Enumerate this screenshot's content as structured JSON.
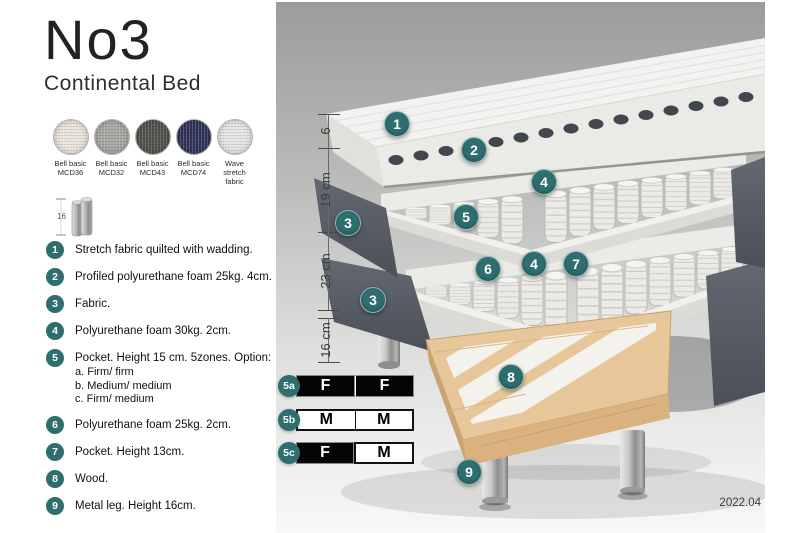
{
  "colors": {
    "accent": "#2e6e6e",
    "navy_swatch": "#32355a",
    "panel_top_gray": "#9c9c9c"
  },
  "header": {
    "title": "No3",
    "subtitle": "Continental Bed"
  },
  "swatches": [
    {
      "line1": "Bell basic",
      "line2": "MCD36",
      "color": "#e9e5db"
    },
    {
      "line1": "Bell basic",
      "line2": "MCD32",
      "color": "#a8a6a2"
    },
    {
      "line1": "Bell basic",
      "line2": "MCD43",
      "color": "#53514d"
    },
    {
      "line1": "Bell basic",
      "line2": "MCD74",
      "color": "#32355a"
    },
    {
      "line1": "Wave",
      "line2": "stretch fabric",
      "color": "#e3e5e7"
    }
  ],
  "leg_icon": {
    "label": "16"
  },
  "legend": [
    {
      "num": "1",
      "text": "Stretch fabric quilted with wadding."
    },
    {
      "num": "2",
      "text": "Profiled polyurethane foam 25kg. 4cm."
    },
    {
      "num": "3",
      "text": "Fabric."
    },
    {
      "num": "4",
      "text": "Polyurethane foam 30kg. 2cm."
    },
    {
      "num": "5",
      "text": "Pocket. Height 15 cm. 5zones. Option:",
      "options": [
        "a. Firm/ firm",
        "b. Medium/ medium",
        "c. Firm/ medium"
      ]
    },
    {
      "num": "6",
      "text": "Polyurethane foam 25kg. 2cm."
    },
    {
      "num": "7",
      "text": "Pocket. Height 13cm."
    },
    {
      "num": "8",
      "text": "Wood."
    },
    {
      "num": "9",
      "text": "Metal leg. Height 16cm."
    }
  ],
  "diagram": {
    "measurements": [
      "6",
      "19 cm",
      "23 cm",
      "16 cm"
    ],
    "callouts": {
      "c1": "1",
      "c2": "2",
      "c3_upper": "3",
      "c3_lower": "3",
      "c4_upper": "4",
      "c4_lower": "4",
      "c5": "5",
      "c6": "6",
      "c7": "7",
      "c8": "8",
      "c9": "9"
    },
    "firmness": [
      {
        "label": "5a",
        "left": "F",
        "right": "F"
      },
      {
        "label": "5b",
        "left": "M",
        "right": "M"
      },
      {
        "label": "5c",
        "left": "F",
        "right": "M"
      }
    ],
    "version": "2022.04"
  }
}
